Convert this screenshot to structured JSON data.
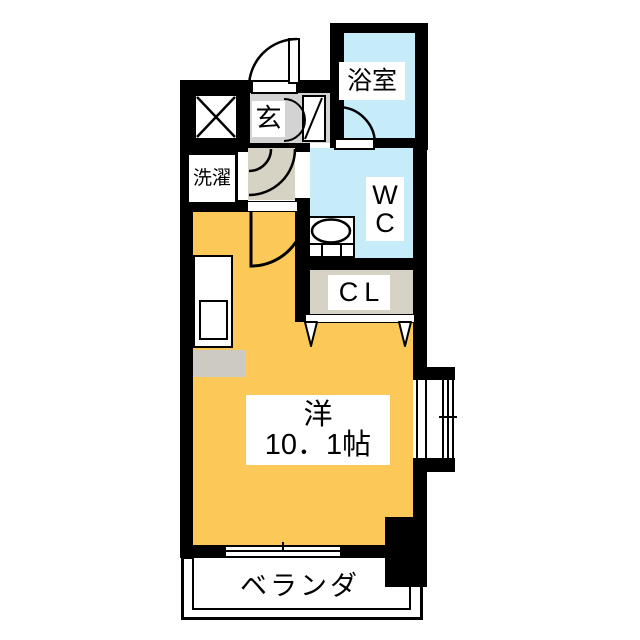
{
  "plan_type": "apartment-floor-plan",
  "labels": {
    "bath": "浴室",
    "entrance": "玄",
    "laundry": "洗濯",
    "wc_lines": [
      "W",
      "C"
    ],
    "closet": "CL",
    "main_room_type": "洋",
    "main_room_size": "10．1帖",
    "veranda": "ベランダ"
  },
  "colors": {
    "wall": "#000000",
    "water_room": "#c5ecf8",
    "main_room": "#fcc857",
    "hallway": "#d6d2c4",
    "entrance_floor": "#d3d3d3",
    "closet_floor": "#d6d2c4",
    "appliance_gray": "#cdcac3"
  }
}
